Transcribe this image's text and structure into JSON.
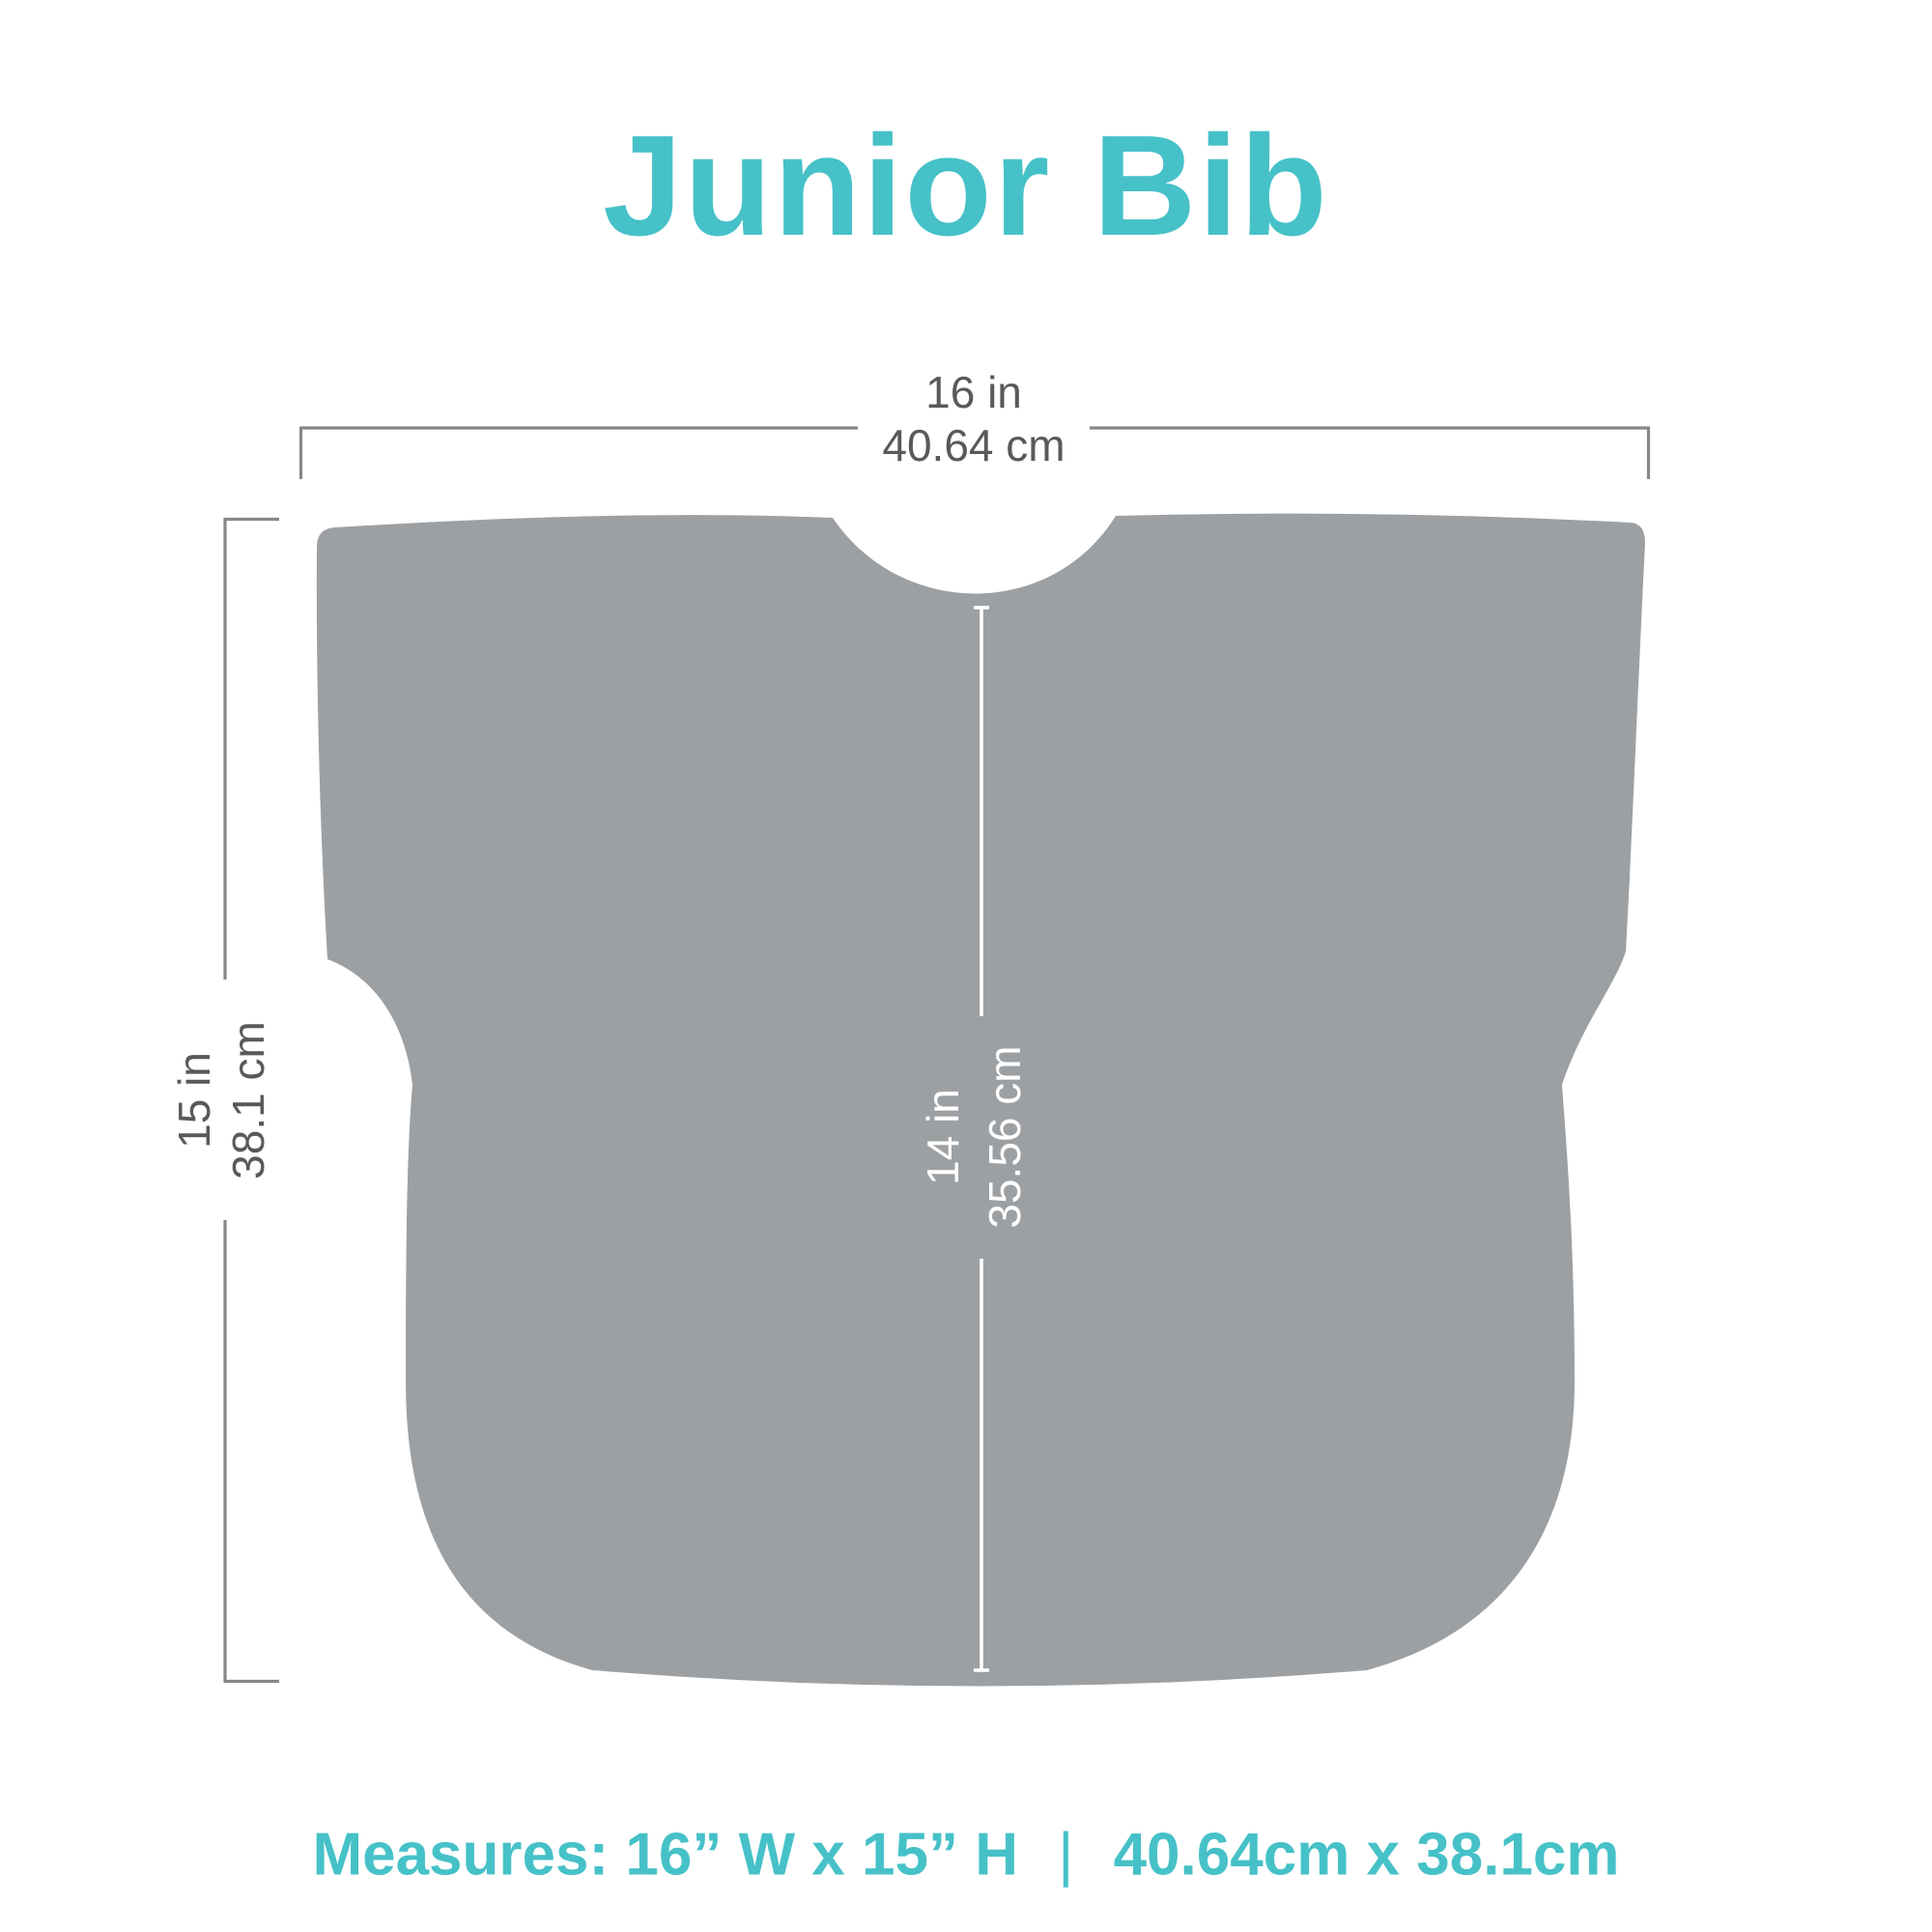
{
  "title": "Junior Bib",
  "colors": {
    "accent_teal": "#46C1C8",
    "bib_gray": "#9DA0A3",
    "dimension_line_gray": "#85878A",
    "dimension_text_gray": "#58595B",
    "inner_dimension_white": "#FFFFFF",
    "background": "#FFFFFF"
  },
  "dimensions": {
    "width": {
      "imperial": "16 in",
      "metric": "40.64 cm"
    },
    "height": {
      "imperial": "15 in",
      "metric": "38.1 cm"
    },
    "center_length": {
      "imperial": "14 in",
      "metric": "35.56 cm"
    }
  },
  "caption": {
    "label": "Measures:",
    "imperial": "16” W x 15” H",
    "separator": "|",
    "metric": "40.64cm x 38.1cm"
  }
}
